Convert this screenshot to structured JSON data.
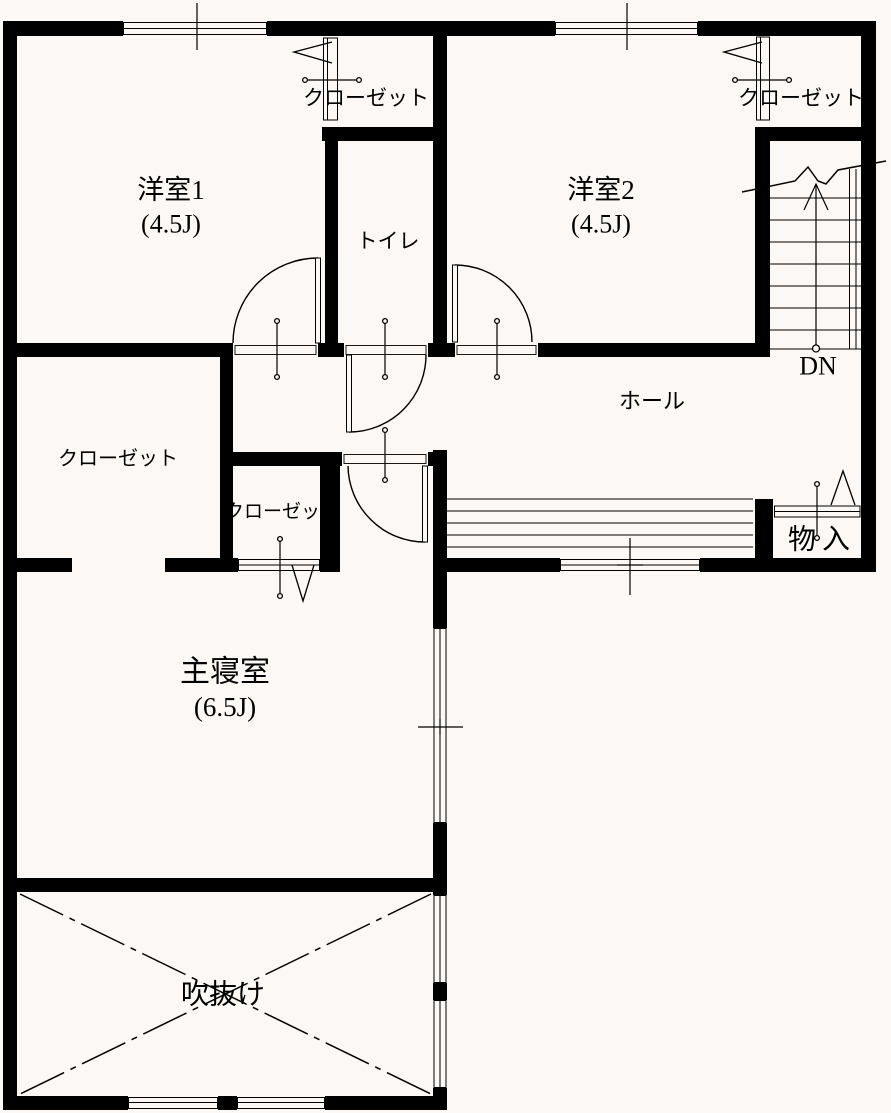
{
  "colors": {
    "background": "#fcf8f5",
    "wall": "#000000",
    "line": "#000000"
  },
  "labels": {
    "room1_name": "洋室1",
    "room1_size": "(4.5J)",
    "room2_name": "洋室2",
    "room2_size": "(4.5J)",
    "toilet": "トイレ",
    "closet_room1": "クローゼット",
    "closet_room2": "クローゼット",
    "closet_master_large": "クローゼット",
    "closet_master_small": "クローゼット",
    "hall": "ホール",
    "stairs_direction": "DN",
    "storage": "物入",
    "master_name": "主寝室",
    "master_size": "(6.5J)",
    "void": "吹抜け"
  }
}
